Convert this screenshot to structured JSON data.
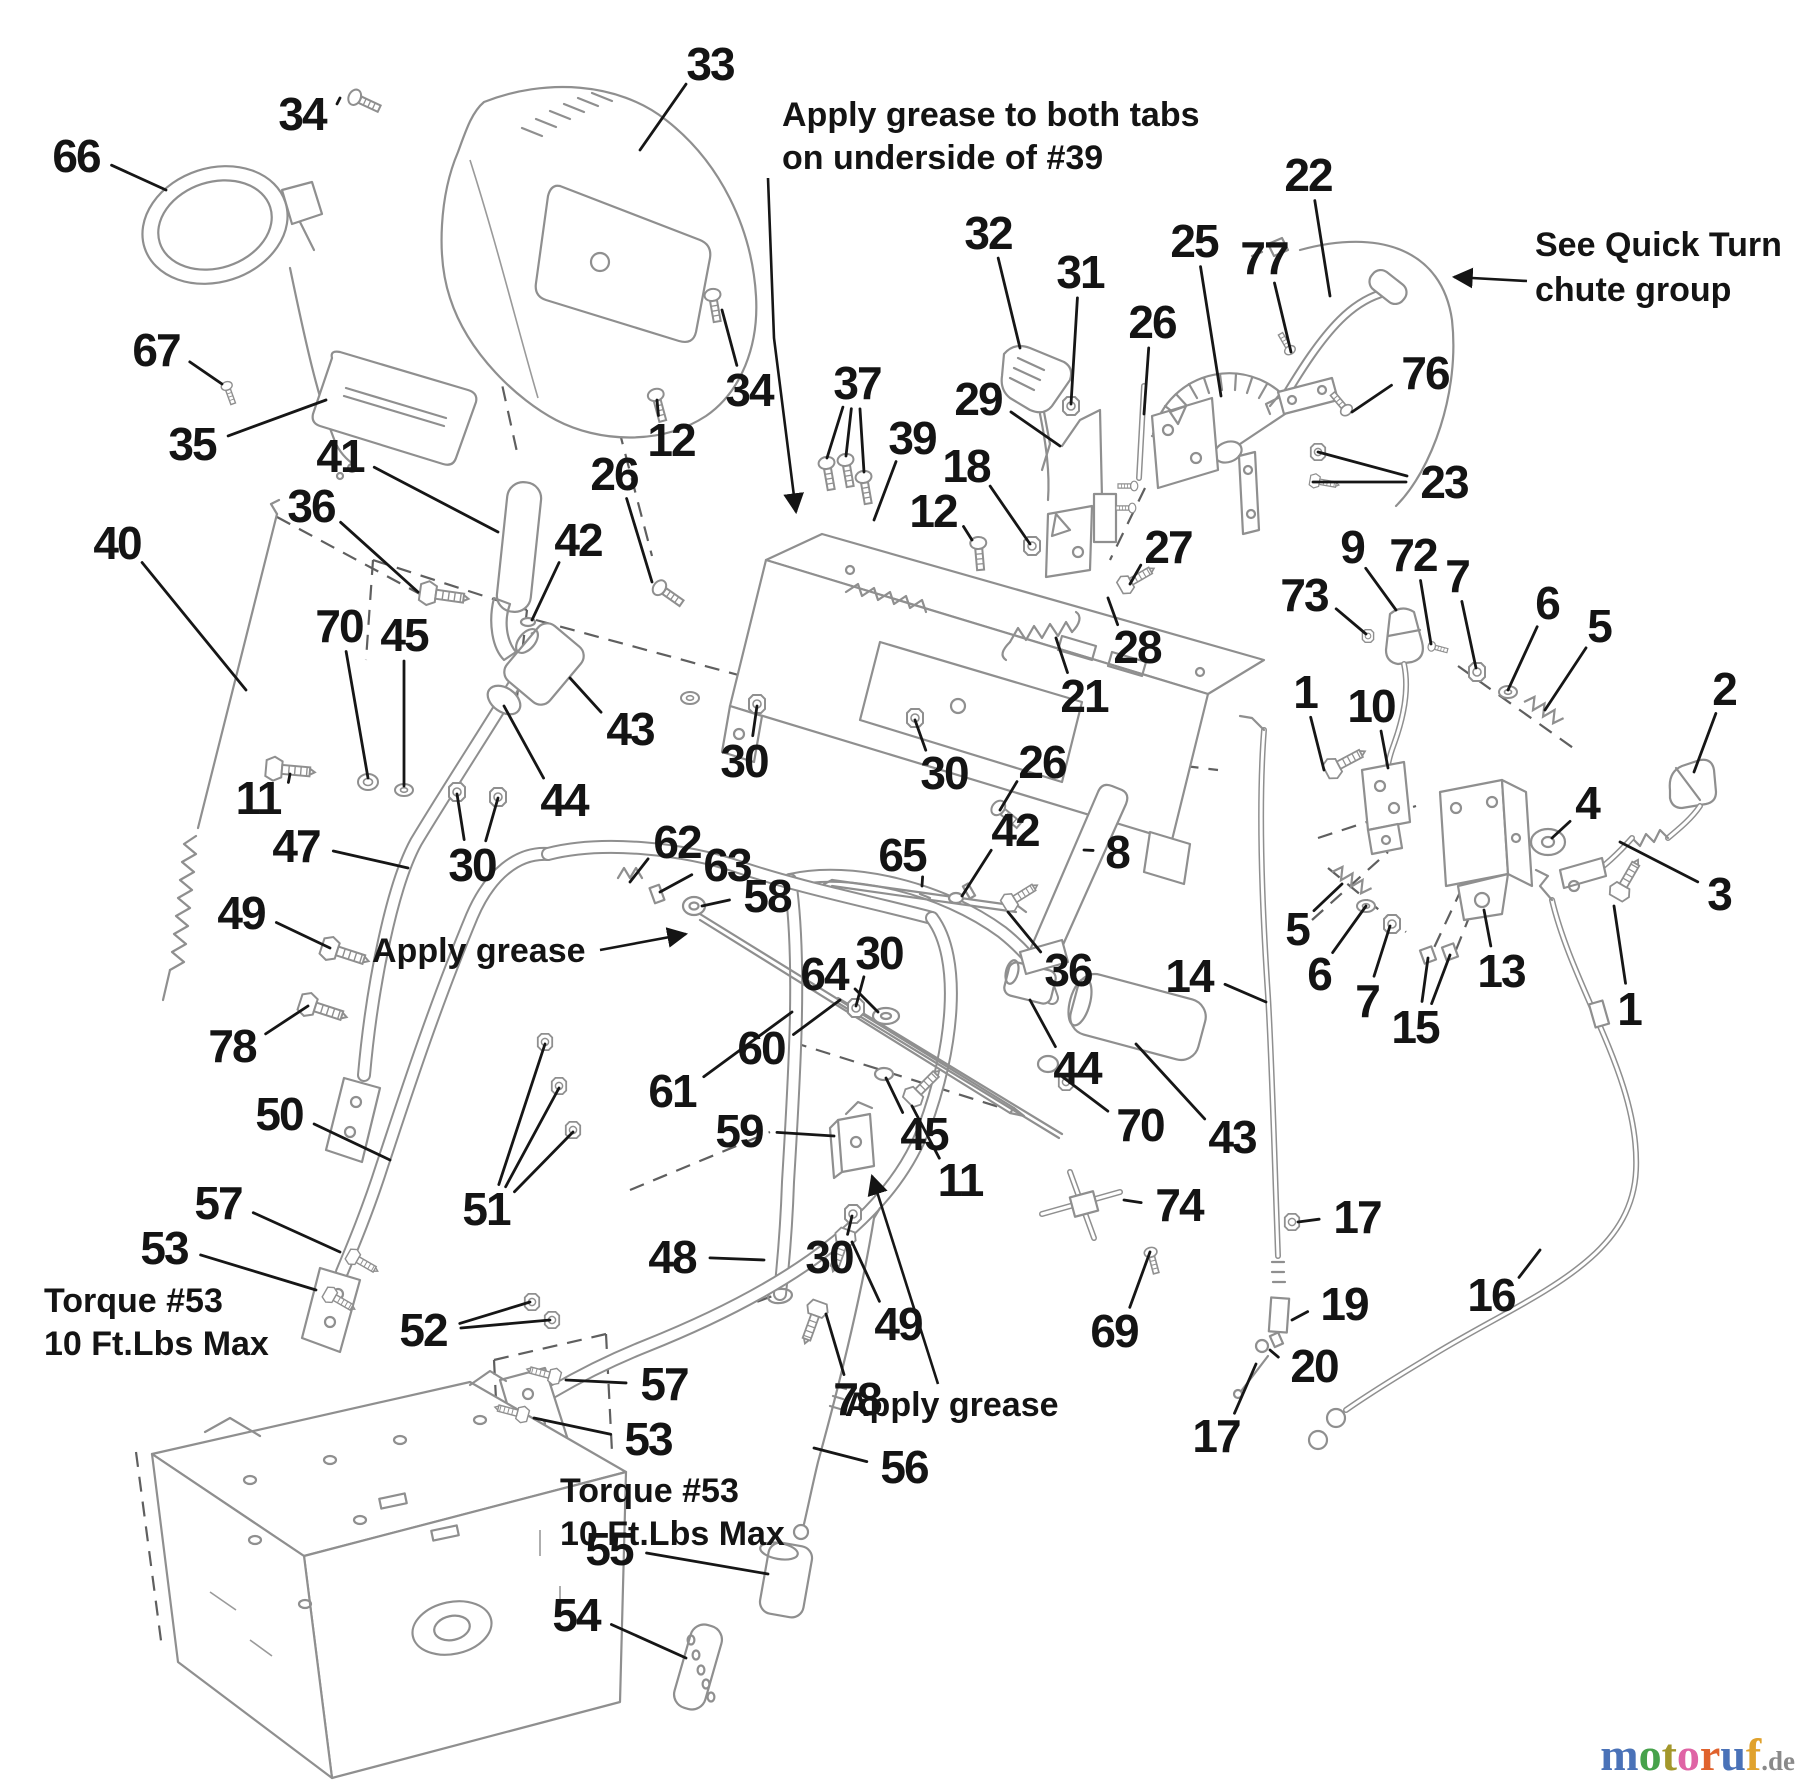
{
  "canvas": {
    "width": 1800,
    "height": 1786,
    "background": "#ffffff"
  },
  "style": {
    "label_color": "#141414",
    "part_line_color": "#8f8f8f",
    "leader_color": "#161616",
    "hidden_line_color": "#5f5f5f",
    "label_font_size": 46,
    "annotation_font_size": 34
  },
  "annotations": [
    {
      "id": "grease-tabs-note",
      "lines": [
        "Apply grease to both tabs",
        "on underside of #39"
      ],
      "x": 782,
      "y": 96,
      "line_height": 43,
      "leader": [
        [
          768,
          178
        ],
        [
          774,
          338
        ],
        [
          796,
          512
        ]
      ],
      "arrow": true
    },
    {
      "id": "quick-turn-note",
      "lines": [
        "See Quick Turn",
        "chute group"
      ],
      "x": 1535,
      "y": 226,
      "line_height": 45,
      "leader": [
        [
          1527,
          281
        ],
        [
          1454,
          277
        ]
      ],
      "arrow": true
    },
    {
      "id": "apply-grease-left",
      "lines": [
        "Apply grease"
      ],
      "x": 372,
      "y": 932,
      "line_height": 40,
      "leader": [
        [
          600,
          950
        ],
        [
          686,
          934
        ]
      ],
      "arrow": true
    },
    {
      "id": "apply-grease-bottom",
      "lines": [
        "Apply grease"
      ],
      "x": 845,
      "y": 1386,
      "line_height": 40,
      "leader": [
        [
          938,
          1384
        ],
        [
          872,
          1176
        ]
      ],
      "arrow": true
    },
    {
      "id": "torque-note-left",
      "lines": [
        "Torque #53",
        "10 Ft.Lbs Max"
      ],
      "x": 44,
      "y": 1282,
      "line_height": 43
    },
    {
      "id": "torque-note-right",
      "lines": [
        "Torque #53",
        "10 Ft.Lbs Max"
      ],
      "x": 560,
      "y": 1472,
      "line_height": 43
    }
  ],
  "part_labels": [
    {
      "text": "33",
      "x": 710,
      "y": 64,
      "targets": [
        [
          640,
          150
        ]
      ]
    },
    {
      "text": "34",
      "x": 302,
      "y": 114,
      "targets": [
        [
          340,
          98
        ]
      ]
    },
    {
      "text": "66",
      "x": 76,
      "y": 156,
      "targets": [
        [
          166,
          190
        ]
      ]
    },
    {
      "text": "67",
      "x": 156,
      "y": 350,
      "targets": [
        [
          222,
          384
        ]
      ]
    },
    {
      "text": "35",
      "x": 192,
      "y": 444,
      "targets": [
        [
          326,
          400
        ]
      ]
    },
    {
      "text": "34",
      "x": 749,
      "y": 390,
      "targets": [
        [
          722,
          310
        ]
      ]
    },
    {
      "text": "41",
      "x": 340,
      "y": 456,
      "targets": [
        [
          498,
          532
        ]
      ]
    },
    {
      "text": "36",
      "x": 311,
      "y": 506,
      "targets": [
        [
          418,
          592
        ]
      ]
    },
    {
      "text": "26",
      "x": 614,
      "y": 474,
      "targets": [
        [
          652,
          582
        ]
      ]
    },
    {
      "text": "12",
      "x": 671,
      "y": 440,
      "targets": [
        [
          657,
          400
        ]
      ]
    },
    {
      "text": "37",
      "x": 857,
      "y": 383,
      "targets": [
        [
          827,
          458
        ],
        [
          846,
          456
        ],
        [
          864,
          472
        ]
      ]
    },
    {
      "text": "39",
      "x": 912,
      "y": 438,
      "targets": [
        [
          874,
          520
        ]
      ]
    },
    {
      "text": "32",
      "x": 988,
      "y": 233,
      "targets": [
        [
          1020,
          348
        ]
      ]
    },
    {
      "text": "31",
      "x": 1080,
      "y": 272,
      "targets": [
        [
          1071,
          404
        ]
      ]
    },
    {
      "text": "26",
      "x": 1152,
      "y": 322,
      "targets": [
        [
          1144,
          414
        ]
      ]
    },
    {
      "text": "25",
      "x": 1194,
      "y": 241,
      "targets": [
        [
          1221,
          396
        ]
      ]
    },
    {
      "text": "77",
      "x": 1264,
      "y": 258,
      "targets": [
        [
          1291,
          352
        ]
      ]
    },
    {
      "text": "22",
      "x": 1308,
      "y": 175,
      "targets": [
        [
          1330,
          296
        ]
      ]
    },
    {
      "text": "76",
      "x": 1425,
      "y": 373,
      "targets": [
        [
          1352,
          412
        ]
      ]
    },
    {
      "text": "23",
      "x": 1444,
      "y": 482,
      "targets": [
        [
          1318,
          452
        ],
        [
          1313,
          482
        ]
      ]
    },
    {
      "text": "29",
      "x": 978,
      "y": 399,
      "targets": [
        [
          1060,
          446
        ]
      ]
    },
    {
      "text": "18",
      "x": 966,
      "y": 466,
      "targets": [
        [
          1030,
          544
        ]
      ]
    },
    {
      "text": "12",
      "x": 933,
      "y": 511,
      "targets": [
        [
          972,
          540
        ]
      ]
    },
    {
      "text": "27",
      "x": 1168,
      "y": 547,
      "targets": [
        [
          1130,
          584
        ]
      ]
    },
    {
      "text": "28",
      "x": 1137,
      "y": 647,
      "targets": [
        [
          1108,
          598
        ]
      ]
    },
    {
      "text": "21",
      "x": 1084,
      "y": 696,
      "targets": [
        [
          1056,
          638
        ]
      ]
    },
    {
      "text": "26",
      "x": 1042,
      "y": 762,
      "targets": [
        [
          1000,
          810
        ]
      ]
    },
    {
      "text": "30",
      "x": 744,
      "y": 761,
      "targets": [
        [
          757,
          706
        ]
      ]
    },
    {
      "text": "30",
      "x": 944,
      "y": 773,
      "targets": [
        [
          915,
          720
        ]
      ]
    },
    {
      "text": "40",
      "x": 117,
      "y": 543,
      "targets": [
        [
          246,
          690
        ]
      ]
    },
    {
      "text": "42",
      "x": 578,
      "y": 540,
      "targets": [
        [
          532,
          620
        ]
      ]
    },
    {
      "text": "70",
      "x": 339,
      "y": 626,
      "targets": [
        [
          368,
          778
        ]
      ]
    },
    {
      "text": "45",
      "x": 404,
      "y": 635,
      "targets": [
        [
          404,
          786
        ]
      ]
    },
    {
      "text": "11",
      "x": 258,
      "y": 798,
      "targets": [
        [
          290,
          774
        ]
      ]
    },
    {
      "text": "47",
      "x": 296,
      "y": 846,
      "targets": [
        [
          408,
          868
        ]
      ]
    },
    {
      "text": "49",
      "x": 241,
      "y": 913,
      "targets": [
        [
          330,
          948
        ]
      ]
    },
    {
      "text": "78",
      "x": 232,
      "y": 1046,
      "targets": [
        [
          308,
          1006
        ]
      ]
    },
    {
      "text": "43",
      "x": 630,
      "y": 729,
      "targets": [
        [
          570,
          678
        ]
      ]
    },
    {
      "text": "44",
      "x": 564,
      "y": 800,
      "targets": [
        [
          504,
          706
        ]
      ]
    },
    {
      "text": "30",
      "x": 472,
      "y": 865,
      "targets": [
        [
          457,
          794
        ],
        [
          498,
          798
        ]
      ]
    },
    {
      "text": "62",
      "x": 677,
      "y": 842,
      "targets": [
        [
          630,
          882
        ]
      ]
    },
    {
      "text": "63",
      "x": 727,
      "y": 865,
      "targets": [
        [
          660,
          892
        ]
      ]
    },
    {
      "text": "58",
      "x": 767,
      "y": 896,
      "targets": [
        [
          702,
          906
        ]
      ]
    },
    {
      "text": "65",
      "x": 902,
      "y": 855,
      "targets": [
        [
          922,
          886
        ]
      ]
    },
    {
      "text": "42",
      "x": 1015,
      "y": 830,
      "targets": [
        [
          962,
          896
        ]
      ]
    },
    {
      "text": "8",
      "x": 1117,
      "y": 852,
      "targets": [
        [
          1084,
          850
        ]
      ]
    },
    {
      "text": "36",
      "x": 1068,
      "y": 970,
      "targets": [
        [
          1008,
          912
        ]
      ]
    },
    {
      "text": "30",
      "x": 879,
      "y": 953,
      "targets": [
        [
          856,
          1006
        ]
      ]
    },
    {
      "text": "64",
      "x": 824,
      "y": 974,
      "targets": [
        [
          878,
          1012
        ]
      ]
    },
    {
      "text": "60",
      "x": 761,
      "y": 1048,
      "targets": [
        [
          840,
          1000
        ]
      ]
    },
    {
      "text": "61",
      "x": 672,
      "y": 1091,
      "targets": [
        [
          792,
          1012
        ]
      ]
    },
    {
      "text": "59",
      "x": 739,
      "y": 1131,
      "targets": [
        [
          834,
          1136
        ]
      ]
    },
    {
      "text": "45",
      "x": 924,
      "y": 1134,
      "targets": [
        [
          886,
          1078
        ]
      ]
    },
    {
      "text": "11",
      "x": 960,
      "y": 1180,
      "targets": [
        [
          912,
          1106
        ]
      ]
    },
    {
      "text": "44",
      "x": 1077,
      "y": 1068,
      "targets": [
        [
          1030,
          1000
        ]
      ]
    },
    {
      "text": "70",
      "x": 1140,
      "y": 1125,
      "targets": [
        [
          1056,
          1072
        ]
      ]
    },
    {
      "text": "43",
      "x": 1232,
      "y": 1137,
      "targets": [
        [
          1136,
          1044
        ]
      ]
    },
    {
      "text": "14",
      "x": 1189,
      "y": 976,
      "targets": [
        [
          1266,
          1002
        ]
      ]
    },
    {
      "text": "9",
      "x": 1352,
      "y": 547,
      "targets": [
        [
          1396,
          610
        ]
      ]
    },
    {
      "text": "72",
      "x": 1413,
      "y": 555,
      "targets": [
        [
          1431,
          644
        ]
      ]
    },
    {
      "text": "7",
      "x": 1457,
      "y": 576,
      "targets": [
        [
          1476,
          668
        ]
      ]
    },
    {
      "text": "73",
      "x": 1304,
      "y": 595,
      "targets": [
        [
          1366,
          634
        ]
      ]
    },
    {
      "text": "6",
      "x": 1547,
      "y": 603,
      "targets": [
        [
          1508,
          690
        ]
      ]
    },
    {
      "text": "5",
      "x": 1599,
      "y": 626,
      "targets": [
        [
          1545,
          710
        ]
      ]
    },
    {
      "text": "2",
      "x": 1724,
      "y": 689,
      "targets": [
        [
          1694,
          772
        ]
      ]
    },
    {
      "text": "1",
      "x": 1305,
      "y": 692,
      "targets": [
        [
          1324,
          770
        ]
      ]
    },
    {
      "text": "10",
      "x": 1371,
      "y": 706,
      "targets": [
        [
          1388,
          768
        ]
      ]
    },
    {
      "text": "4",
      "x": 1587,
      "y": 803,
      "targets": [
        [
          1552,
          838
        ]
      ]
    },
    {
      "text": "3",
      "x": 1719,
      "y": 894,
      "targets": [
        [
          1620,
          842
        ]
      ]
    },
    {
      "text": "5",
      "x": 1297,
      "y": 929,
      "targets": [
        [
          1342,
          884
        ]
      ]
    },
    {
      "text": "6",
      "x": 1319,
      "y": 974,
      "targets": [
        [
          1366,
          906
        ]
      ]
    },
    {
      "text": "7",
      "x": 1367,
      "y": 1001,
      "targets": [
        [
          1390,
          926
        ]
      ]
    },
    {
      "text": "13",
      "x": 1501,
      "y": 971,
      "targets": [
        [
          1484,
          910
        ]
      ]
    },
    {
      "text": "15",
      "x": 1415,
      "y": 1027,
      "targets": [
        [
          1428,
          958
        ],
        [
          1450,
          955
        ]
      ]
    },
    {
      "text": "1",
      "x": 1629,
      "y": 1009,
      "targets": [
        [
          1614,
          906
        ]
      ]
    },
    {
      "text": "74",
      "x": 1179,
      "y": 1205,
      "targets": [
        [
          1124,
          1200
        ]
      ]
    },
    {
      "text": "69",
      "x": 1114,
      "y": 1331,
      "targets": [
        [
          1150,
          1252
        ]
      ]
    },
    {
      "text": "17",
      "x": 1357,
      "y": 1217,
      "targets": [
        [
          1298,
          1222
        ]
      ]
    },
    {
      "text": "19",
      "x": 1344,
      "y": 1304,
      "targets": [
        [
          1292,
          1320
        ]
      ]
    },
    {
      "text": "20",
      "x": 1314,
      "y": 1366,
      "targets": [
        [
          1270,
          1350
        ]
      ]
    },
    {
      "text": "17",
      "x": 1216,
      "y": 1436,
      "targets": [
        [
          1256,
          1364
        ]
      ]
    },
    {
      "text": "16",
      "x": 1491,
      "y": 1295,
      "targets": [
        [
          1540,
          1250
        ]
      ]
    },
    {
      "text": "50",
      "x": 279,
      "y": 1114,
      "targets": [
        [
          390,
          1160
        ]
      ]
    },
    {
      "text": "51",
      "x": 486,
      "y": 1209,
      "targets": [
        [
          545,
          1044
        ],
        [
          559,
          1088
        ],
        [
          573,
          1132
        ]
      ]
    },
    {
      "text": "57",
      "x": 218,
      "y": 1203,
      "targets": [
        [
          340,
          1252
        ]
      ]
    },
    {
      "text": "53",
      "x": 164,
      "y": 1248,
      "targets": [
        [
          316,
          1290
        ]
      ]
    },
    {
      "text": "52",
      "x": 423,
      "y": 1330,
      "targets": [
        [
          530,
          1302
        ],
        [
          550,
          1320
        ]
      ]
    },
    {
      "text": "48",
      "x": 672,
      "y": 1257,
      "targets": [
        [
          764,
          1260
        ]
      ]
    },
    {
      "text": "49",
      "x": 898,
      "y": 1324,
      "targets": [
        [
          852,
          1242
        ]
      ]
    },
    {
      "text": "78",
      "x": 857,
      "y": 1399,
      "targets": [
        [
          826,
          1314
        ]
      ]
    },
    {
      "text": "30",
      "x": 829,
      "y": 1257,
      "targets": [
        [
          852,
          1216
        ]
      ]
    },
    {
      "text": "57",
      "x": 664,
      "y": 1384,
      "targets": [
        [
          566,
          1380
        ]
      ]
    },
    {
      "text": "53",
      "x": 648,
      "y": 1439,
      "targets": [
        [
          534,
          1418
        ]
      ]
    },
    {
      "text": "55",
      "x": 609,
      "y": 1549,
      "targets": [
        [
          768,
          1574
        ]
      ]
    },
    {
      "text": "54",
      "x": 576,
      "y": 1615,
      "targets": [
        [
          686,
          1658
        ]
      ]
    },
    {
      "text": "56",
      "x": 904,
      "y": 1467,
      "targets": [
        [
          814,
          1448
        ]
      ]
    }
  ],
  "watermark": {
    "letters": [
      {
        "ch": "m",
        "color": "#4a72b8"
      },
      {
        "ch": "o",
        "color": "#46a24b"
      },
      {
        "ch": "t",
        "color": "#a3972b"
      },
      {
        "ch": "o",
        "color": "#df64a5"
      },
      {
        "ch": "r",
        "color": "#e0622d"
      },
      {
        "ch": "u",
        "color": "#4a72b8"
      },
      {
        "ch": "f",
        "color": "#e0a22d"
      }
    ],
    "suffix": ".de",
    "suffix_color": "#8a8a8a",
    "x": 1795,
    "y": 1770
  }
}
